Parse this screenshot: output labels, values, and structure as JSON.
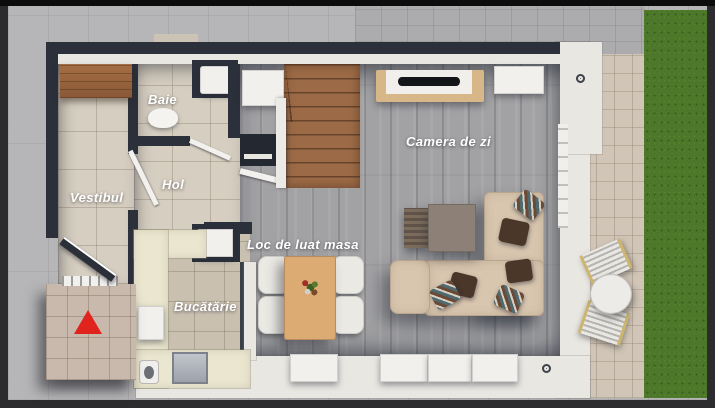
{
  "plan": {
    "rooms": {
      "vestibul": {
        "label": "Vestibul"
      },
      "baie": {
        "label": "Baie"
      },
      "hol": {
        "label": "Hol"
      },
      "living": {
        "label": "Camera de zi"
      },
      "dining": {
        "label": "Loc de luat masa"
      },
      "kitchen": {
        "label": "Bucătărie"
      }
    },
    "markers": {
      "entrance": {
        "icon": "entrance-arrow-icon",
        "color": "#e0231c"
      }
    },
    "palette": {
      "wall_dark": "#2b303b",
      "wall_white": "#e9e7e2",
      "tile_floor": "#d6cec0",
      "wood_floor": "#a2a2a4",
      "kitchen_floor": "#c9c0b0",
      "counter": "#eae6cf",
      "stair_wood": "#9c6a46",
      "dining_table_wood": "#dcab74",
      "sofa": "#d9c6af",
      "grass": "#4e7829",
      "patio": "#d1c5b7",
      "pavement": "#b6b5b7"
    }
  }
}
